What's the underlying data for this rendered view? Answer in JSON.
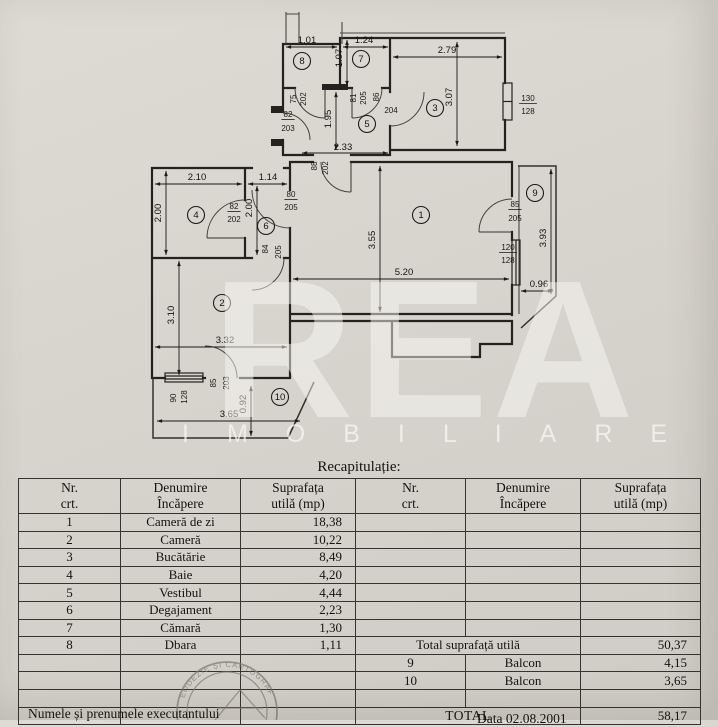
{
  "title": "Recapitulație:",
  "table": {
    "header": {
      "nr": [
        "Nr.",
        "crt."
      ],
      "name": [
        "Denumire",
        "Încăpere"
      ],
      "area": [
        "Suprafața",
        "utilă (mp)"
      ]
    },
    "rows": [
      {
        "nr": "1",
        "name": "Cameră de zi",
        "area": "18,38"
      },
      {
        "nr": "2",
        "name": "Cameră",
        "area": "10,22"
      },
      {
        "nr": "3",
        "name": "Bucătărie",
        "area": "8,49"
      },
      {
        "nr": "4",
        "name": "Baie",
        "area": "4,20"
      },
      {
        "nr": "5",
        "name": "Vestibul",
        "area": "4,44"
      },
      {
        "nr": "6",
        "name": "Degajament",
        "area": "2,23"
      },
      {
        "nr": "7",
        "name": "Cămară",
        "area": "1,30"
      },
      {
        "nr": "8",
        "name": "Dbara",
        "area": "1,11"
      }
    ],
    "totals": {
      "total_util_label": "Total suprafață utilă",
      "total_util": "50,37",
      "balconies": [
        {
          "nr": "9",
          "name": "Balcon",
          "area": "4,15"
        },
        {
          "nr": "10",
          "name": "Balcon",
          "area": "3,65"
        }
      ],
      "total_label": "TOTAL",
      "total": "58,17"
    }
  },
  "footer": {
    "left": "Numele și prenumele executantului",
    "right": "Data 02.08.2001"
  },
  "watermark": {
    "big": "REA",
    "sub": "IMOBILIARE"
  },
  "stamp": {
    "text": "GEODEZIE ȘI CARTOGRAFIE"
  },
  "colors": {
    "paper": "#d7d4cd",
    "line": "#24221e",
    "stamp": "#807d75"
  },
  "plan": {
    "rooms": [
      {
        "n": "1",
        "x": 421,
        "y": 215
      },
      {
        "n": "2",
        "x": 222,
        "y": 303
      },
      {
        "n": "3",
        "x": 435,
        "y": 108
      },
      {
        "n": "4",
        "x": 196,
        "y": 215
      },
      {
        "n": "5",
        "x": 367,
        "y": 124
      },
      {
        "n": "6",
        "x": 266,
        "y": 226
      },
      {
        "n": "7",
        "x": 361,
        "y": 59
      },
      {
        "n": "8",
        "x": 302,
        "y": 61
      },
      {
        "n": "9",
        "x": 535,
        "y": 193
      },
      {
        "n": "10",
        "x": 280,
        "y": 397
      }
    ],
    "dims": [
      {
        "t": "1.01",
        "x": 307,
        "y": 43
      },
      {
        "t": "1.24",
        "x": 364,
        "y": 43
      },
      {
        "t": "1.07",
        "x": 342,
        "y": 58,
        "r": 1
      },
      {
        "t": "2.79",
        "x": 447,
        "y": 53
      },
      {
        "t": "3.07",
        "x": 452,
        "y": 97,
        "r": 1
      },
      {
        "t": "1.95",
        "x": 331,
        "y": 119,
        "r": 1
      },
      {
        "t": "2.33",
        "x": 343,
        "y": 150
      },
      {
        "t": "2.10",
        "x": 197,
        "y": 180
      },
      {
        "t": "1.14",
        "x": 268,
        "y": 180
      },
      {
        "t": "2.00",
        "x": 161,
        "y": 213,
        "r": 1
      },
      {
        "t": "2.00",
        "x": 252,
        "y": 208,
        "r": 1
      },
      {
        "t": "3.55",
        "x": 375,
        "y": 240,
        "r": 1
      },
      {
        "t": "5.20",
        "x": 404,
        "y": 275
      },
      {
        "t": "3.93",
        "x": 546,
        "y": 238,
        "r": 1
      },
      {
        "t": "0.96",
        "x": 539,
        "y": 287
      },
      {
        "t": "3.10",
        "x": 174,
        "y": 315,
        "r": 1
      },
      {
        "t": "3.32",
        "x": 225,
        "y": 343
      },
      {
        "t": "3.65",
        "x": 229,
        "y": 417
      },
      {
        "t": "0.92",
        "x": 246,
        "y": 404,
        "r": 1
      }
    ],
    "door_labels": [
      {
        "t": "75",
        "x": 296,
        "y": 99,
        "r": 1
      },
      {
        "t": "202",
        "x": 306,
        "y": 99,
        "r": 1
      },
      {
        "t": "81",
        "x": 356,
        "y": 98,
        "r": 1
      },
      {
        "t": "205",
        "x": 366,
        "y": 98,
        "r": 1
      },
      {
        "t": "86",
        "x": 379,
        "y": 97,
        "r": 1
      },
      {
        "t": "204",
        "x": 391,
        "y": 113
      },
      {
        "t": "82",
        "x": 288,
        "y": 117,
        "u": 1
      },
      {
        "t": "203",
        "x": 288,
        "y": 131
      },
      {
        "t": "88",
        "x": 317,
        "y": 166,
        "r": 1
      },
      {
        "t": "202",
        "x": 328,
        "y": 168,
        "r": 1
      },
      {
        "t": "80",
        "x": 291,
        "y": 197,
        "u": 1
      },
      {
        "t": "205",
        "x": 291,
        "y": 210
      },
      {
        "t": "82",
        "x": 234,
        "y": 209,
        "u": 1
      },
      {
        "t": "202",
        "x": 234,
        "y": 222
      },
      {
        "t": "84",
        "x": 268,
        "y": 249,
        "r": 1
      },
      {
        "t": "205",
        "x": 281,
        "y": 252,
        "r": 1
      },
      {
        "t": "85",
        "x": 515,
        "y": 207,
        "u": 1
      },
      {
        "t": "205",
        "x": 515,
        "y": 221
      },
      {
        "t": "120",
        "x": 508,
        "y": 250,
        "u": 1
      },
      {
        "t": "128",
        "x": 508,
        "y": 263
      },
      {
        "t": "130",
        "x": 528,
        "y": 101,
        "u": 1
      },
      {
        "t": "128",
        "x": 528,
        "y": 114
      },
      {
        "t": "85",
        "x": 216,
        "y": 383,
        "r": 1
      },
      {
        "t": "203",
        "x": 229,
        "y": 383,
        "r": 1
      },
      {
        "t": "90",
        "x": 176,
        "y": 398,
        "r": 1
      },
      {
        "t": "128",
        "x": 187,
        "y": 397,
        "r": 1
      }
    ]
  }
}
